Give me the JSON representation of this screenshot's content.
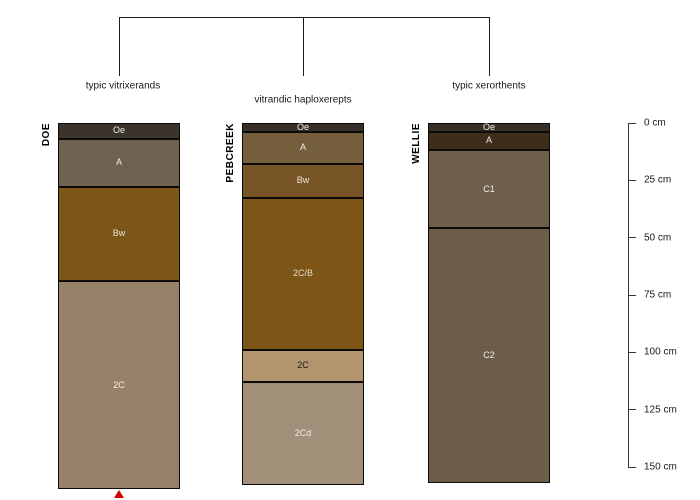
{
  "chart_data": {
    "type": "soil-profile-diagram",
    "title": "",
    "description_visible_text_only": true,
    "depth_axis": {
      "unit": "cm",
      "range_cm": [
        0,
        150
      ],
      "ticks_cm": [
        0,
        25,
        50,
        75,
        100,
        125,
        150
      ],
      "tick_labels": [
        "0 cm",
        "25 cm",
        "50 cm",
        "75 cm",
        "100 cm",
        "125 cm",
        "150 cm"
      ],
      "side": "right"
    },
    "dendrogram": {
      "present": true,
      "leaf_labels": [
        "typic vitrixerands",
        "vitrandic haploxerepts",
        "typic xerorthents"
      ],
      "label_rows": [
        1,
        2,
        1
      ]
    },
    "profiles": [
      {
        "name": "DOE",
        "taxon_label": "typic vitrixerands",
        "bottom_marker": true,
        "horizons": [
          {
            "name": "Oe",
            "top_cm": 0,
            "bottom_cm": 7,
            "color": "#3b342c",
            "label_color": "#f2efe9"
          },
          {
            "name": "A",
            "top_cm": 7,
            "bottom_cm": 28,
            "color": "#6e6150",
            "label_color": "#f2efe9"
          },
          {
            "name": "Bw",
            "top_cm": 28,
            "bottom_cm": 69,
            "color": "#7c5618",
            "label_color": "#efe6d6"
          },
          {
            "name": "2C",
            "top_cm": 69,
            "bottom_cm": 160,
            "color": "#97816a",
            "label_color": "#f4f0ea"
          }
        ]
      },
      {
        "name": "PEBCREEK",
        "taxon_label": "vitrandic haploxerepts",
        "bottom_marker": false,
        "horizons": [
          {
            "name": "Oe",
            "top_cm": 0,
            "bottom_cm": 4,
            "color": "#37302a",
            "label_color": "#f2efe9"
          },
          {
            "name": "A",
            "top_cm": 4,
            "bottom_cm": 18,
            "color": "#745e3e",
            "label_color": "#f2efe9"
          },
          {
            "name": "Bw",
            "top_cm": 18,
            "bottom_cm": 33,
            "color": "#775426",
            "label_color": "#efe6d6"
          },
          {
            "name": "2C/B",
            "top_cm": 33,
            "bottom_cm": 99,
            "color": "#7c5517",
            "label_color": "#e4d9c6"
          },
          {
            "name": "2C",
            "top_cm": 99,
            "bottom_cm": 113,
            "color": "#b2956f",
            "label_color": "#1c1a17"
          },
          {
            "name": "2Cd",
            "top_cm": 113,
            "bottom_cm": 158,
            "color": "#a28f7a",
            "label_color": "#f0ece4"
          }
        ]
      },
      {
        "name": "WELLIE",
        "taxon_label": "typic xerorthents",
        "bottom_marker": false,
        "horizons": [
          {
            "name": "Oe",
            "top_cm": 0,
            "bottom_cm": 4,
            "color": "#37302a",
            "label_color": "#f2efe9"
          },
          {
            "name": "A",
            "top_cm": 4,
            "bottom_cm": 12,
            "color": "#3e2d1b",
            "label_color": "#f2efe9"
          },
          {
            "name": "C1",
            "top_cm": 12,
            "bottom_cm": 46,
            "color": "#6f604e",
            "label_color": "#f2efe9"
          },
          {
            "name": "C2",
            "top_cm": 46,
            "bottom_cm": 157,
            "color": "#6c5d4b",
            "label_color": "#f2efe9"
          }
        ]
      }
    ],
    "marker": {
      "shape": "triangle-up",
      "color": "#d40000",
      "under_profile": "DOE"
    },
    "colors": {
      "line": "#1a1a1a",
      "text": "#1a1a1a",
      "background": "#ffffff"
    }
  }
}
